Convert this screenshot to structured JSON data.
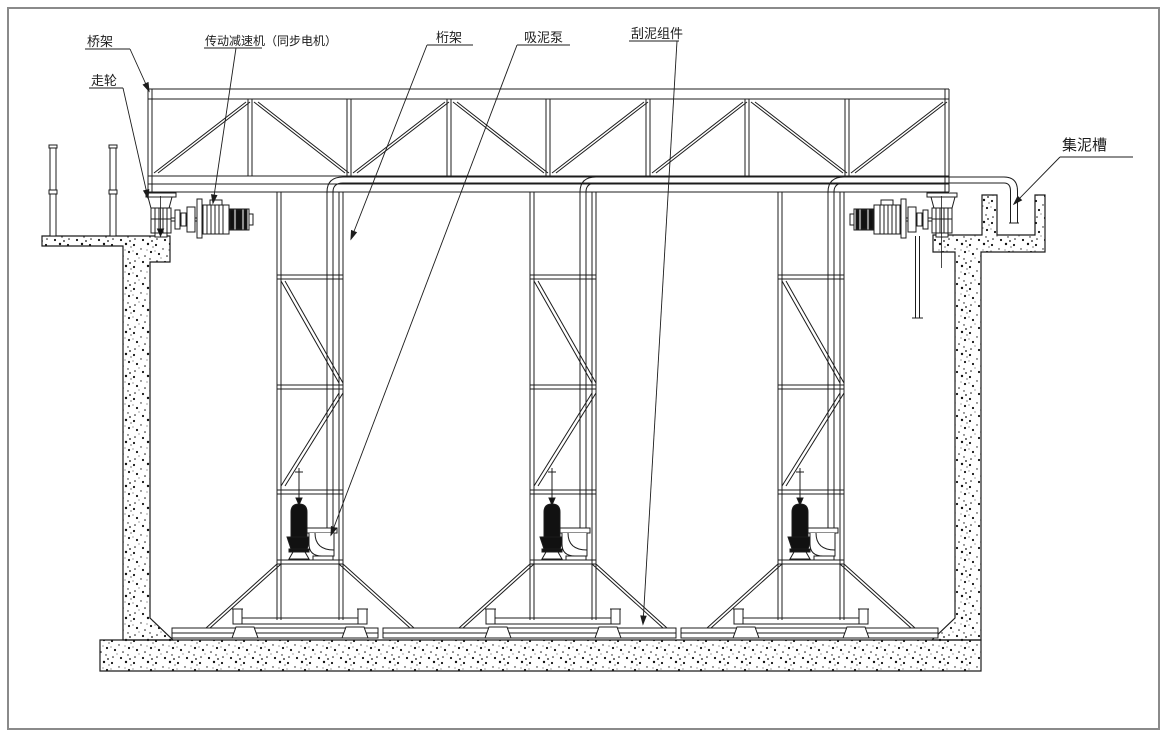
{
  "labels": {
    "bridge_frame": "桥架",
    "travel_wheel": "走轮",
    "drive_reducer": "传动减速机（同步电机）",
    "truss": "桁架",
    "suction_pump": "吸泥泵",
    "scraper_assembly": "刮泥组件",
    "sludge_trough": "集泥槽"
  },
  "colors": {
    "ink": "#1c1c1c",
    "frame": "#8a8a8a",
    "paper": "#ffffff",
    "solid_fill": "#111111"
  }
}
